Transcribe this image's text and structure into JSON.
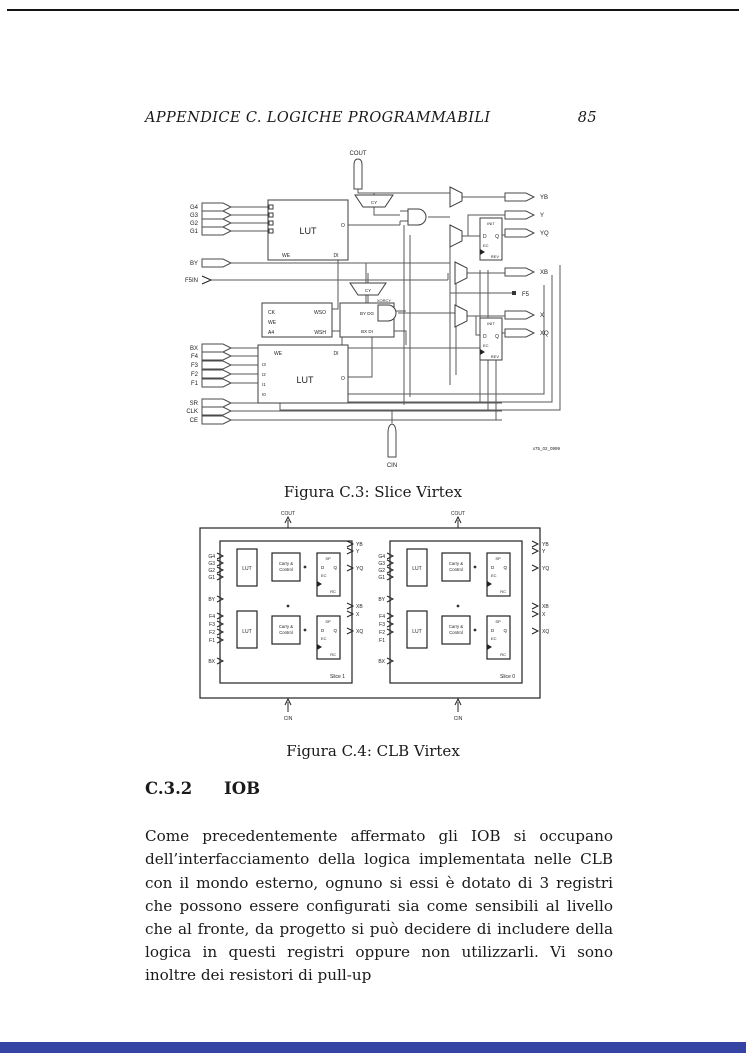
{
  "page": {
    "running_head": "APPENDICE C. LOGICHE PROGRAMMABILI",
    "page_number": "85"
  },
  "figure1": {
    "caption": "Figura C.3: Slice Virtex",
    "cout": "COUT",
    "cin": "CIN",
    "inputs_g": [
      "G4",
      "G3",
      "G2",
      "G1"
    ],
    "by": "BY",
    "f5in": "F5IN",
    "bx": "BX",
    "inputs_f": [
      "F4",
      "F3",
      "F2",
      "F1"
    ],
    "ctrl": [
      "SR",
      "CLK",
      "CE"
    ],
    "lut": "LUT",
    "we": "WE",
    "di": "DI",
    "o": "O",
    "lut_pins": [
      "I3",
      "I2",
      "I1",
      "I0"
    ],
    "wsgen": {
      "ck": "CK",
      "we": "WE",
      "a4": "A4",
      "wso": "WSO",
      "wsh": "WSH"
    },
    "dg_box": {
      "row1": "BY DG",
      "row2": "BX DI"
    },
    "mux_cy": "CY",
    "xorcy": "XORCY",
    "ff": {
      "init": "INIT",
      "d": "D",
      "q": "Q",
      "ec": "EC",
      "rev": "REV"
    },
    "outputs": {
      "yb": "YB",
      "y": "Y",
      "yq": "YQ",
      "xb": "XB",
      "f5": "F5",
      "x": "X",
      "xq": "XQ"
    },
    "watermark": "x75_02_0999"
  },
  "figure2": {
    "caption": "Figura C.4: CLB Virtex",
    "cout": "COUT",
    "cin": "CIN",
    "inputs_g": [
      "G4",
      "G3",
      "G2",
      "G1"
    ],
    "by": "BY",
    "inputs_f": [
      "F4",
      "F3",
      "F2",
      "F1"
    ],
    "bx": "BX",
    "lut": "LUT",
    "carry1": "Carry &",
    "carry2": "Control",
    "ff": {
      "sp": "SP",
      "d": "D",
      "q": "Q",
      "ec": "EC",
      "rc": "RC"
    },
    "outputs": [
      "YB",
      "Y",
      "YQ",
      "XB",
      "X",
      "XQ"
    ],
    "slice_names": [
      "Slice 1",
      "Slice 0"
    ]
  },
  "section": {
    "number": "C.3.2",
    "title": "IOB"
  },
  "body": {
    "paragraph": "Come precedentemente affermato gli IOB si occupano dell’interfacciamento della logica implementata nelle CLB con il mondo esterno, ognuno si essi è dotato di 3 registri che possono essere configurati sia come sensibili al livello che al fronte, da progetto si può decidere di includere della logica in questi registri oppure non utilizzarli. Vi sono inoltre dei resistori di pull-up"
  }
}
